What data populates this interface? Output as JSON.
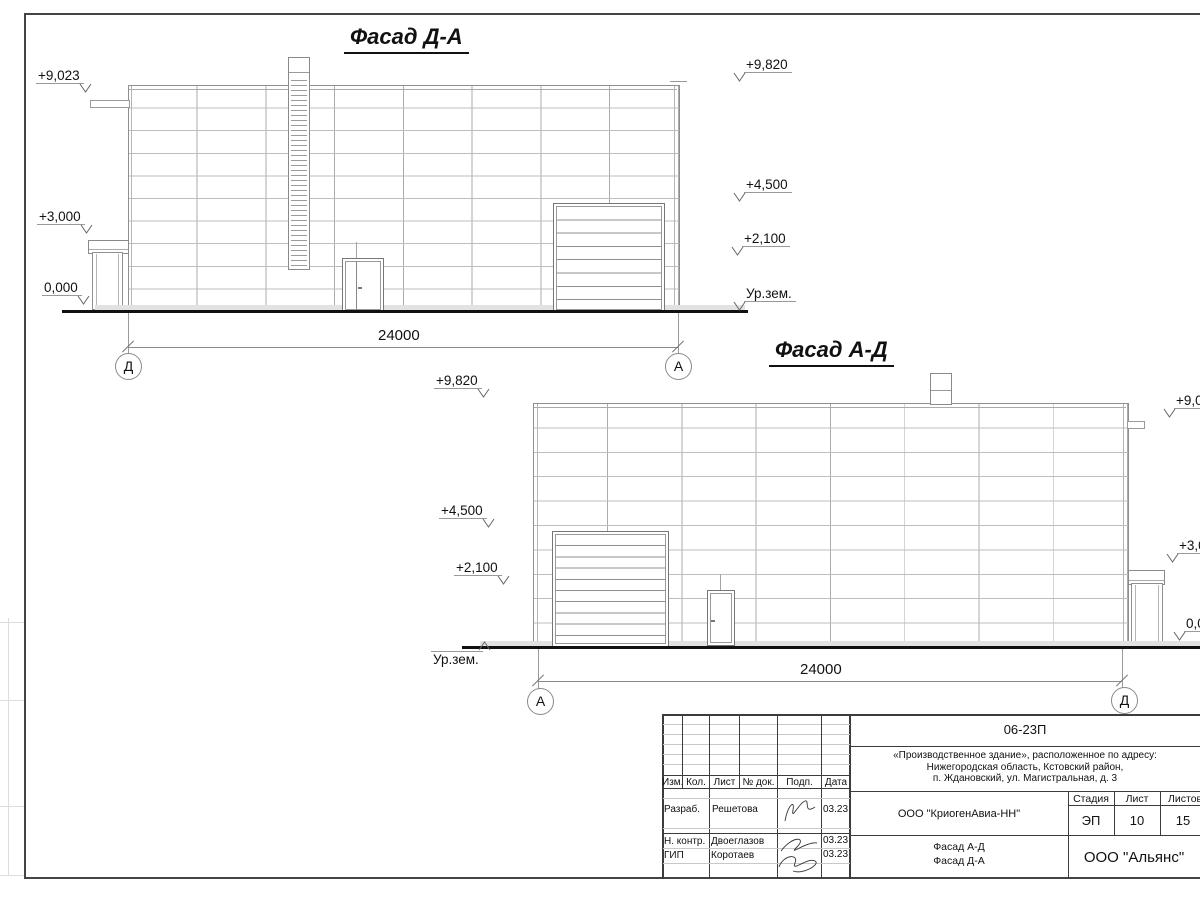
{
  "facades": {
    "top": {
      "title": "Фасад Д-А",
      "dimension": "24000",
      "axis_left": "Д",
      "axis_right": "А",
      "marks_left": [
        "+9,023",
        "+3,000",
        "0,000"
      ],
      "marks_right": [
        "+9,820",
        "+4,500",
        "+2,100",
        "Ур.зем."
      ]
    },
    "bottom": {
      "title": "Фасад А-Д",
      "dimension": "24000",
      "axis_left": "А",
      "axis_right": "Д",
      "marks_left": [
        "+9,820",
        "+4,500",
        "+2,100",
        "Ур.зем."
      ],
      "marks_right": [
        "+9,023",
        "+3,000",
        "0,000"
      ]
    }
  },
  "title_block": {
    "doc_number": "06-23П",
    "address_lines": [
      "«Производственное здание», расположенное по адресу:",
      "Нижегородская область, Кстовский район,",
      "п. Ждановский, ул. Магистральная, д. 3"
    ],
    "rev_headers": [
      "Изм.",
      "Кол.",
      "Лист",
      "№ док.",
      "Подп.",
      "Дата"
    ],
    "roles": [
      {
        "role": "Разраб.",
        "name": "Решетова",
        "date": "03.23"
      },
      {
        "role": "Н. контр.",
        "name": "Двоеглазов",
        "date": "03.23"
      },
      {
        "role": "ГИП",
        "name": "Коротаев",
        "date": "03.23"
      }
    ],
    "company": "ООО \"КриогенАвиа-НН\"",
    "stage_label": "Стадия",
    "sheet_label": "Лист",
    "sheets_label": "Листов",
    "stage": "ЭП",
    "sheet_no": "10",
    "sheets_total": "15",
    "drawing_name_line1": "Фасад А-Д",
    "drawing_name_line2": "Фасад Д-А",
    "contractor": "ООО \"Альянс\""
  }
}
